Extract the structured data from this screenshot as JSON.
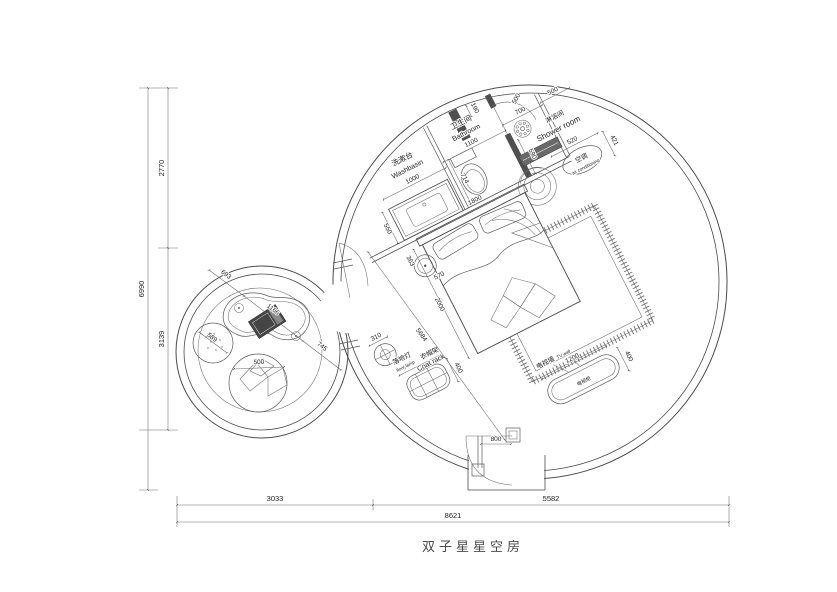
{
  "title": "双子星星空房",
  "dims": {
    "height_total": "6990",
    "height_top": "2770",
    "height_bottom": "3139",
    "width_left": "3033",
    "width_right": "5582",
    "width_total": "8621",
    "room_diag": "5684",
    "entry_door": "800"
  },
  "wash": {
    "cn": "洗漱台",
    "en": "Washbasin",
    "w": "1000",
    "depth": "550"
  },
  "bath": {
    "cn": "卫生间",
    "en": "Bathroom",
    "w": "1100",
    "niche": "190",
    "toilet_off": "714"
  },
  "shower": {
    "cn": "淋浴间",
    "en": "Shower room",
    "w": "700",
    "door": "500",
    "wall": "590"
  },
  "ac": {
    "cn": "空调",
    "en": "air conditioning",
    "w": "520",
    "d": "421"
  },
  "bed": {
    "w": "1800",
    "l": "2000",
    "stool_a": "363",
    "stool_b": "570"
  },
  "tv": {
    "cn": "电视墙",
    "en": "TV wall",
    "cab": "电视柜",
    "w": "1200",
    "d": "400"
  },
  "coat": {
    "cn": "衣帽架",
    "en": "Coat rack",
    "w": "660",
    "d": "400"
  },
  "lamp": {
    "cn": "落地灯",
    "en": "floor lamp",
    "dia": "310"
  },
  "lounge": {
    "seg1": "693",
    "seg2": "1166",
    "seg3": "745",
    "pouf": "589",
    "cushion": "500"
  }
}
